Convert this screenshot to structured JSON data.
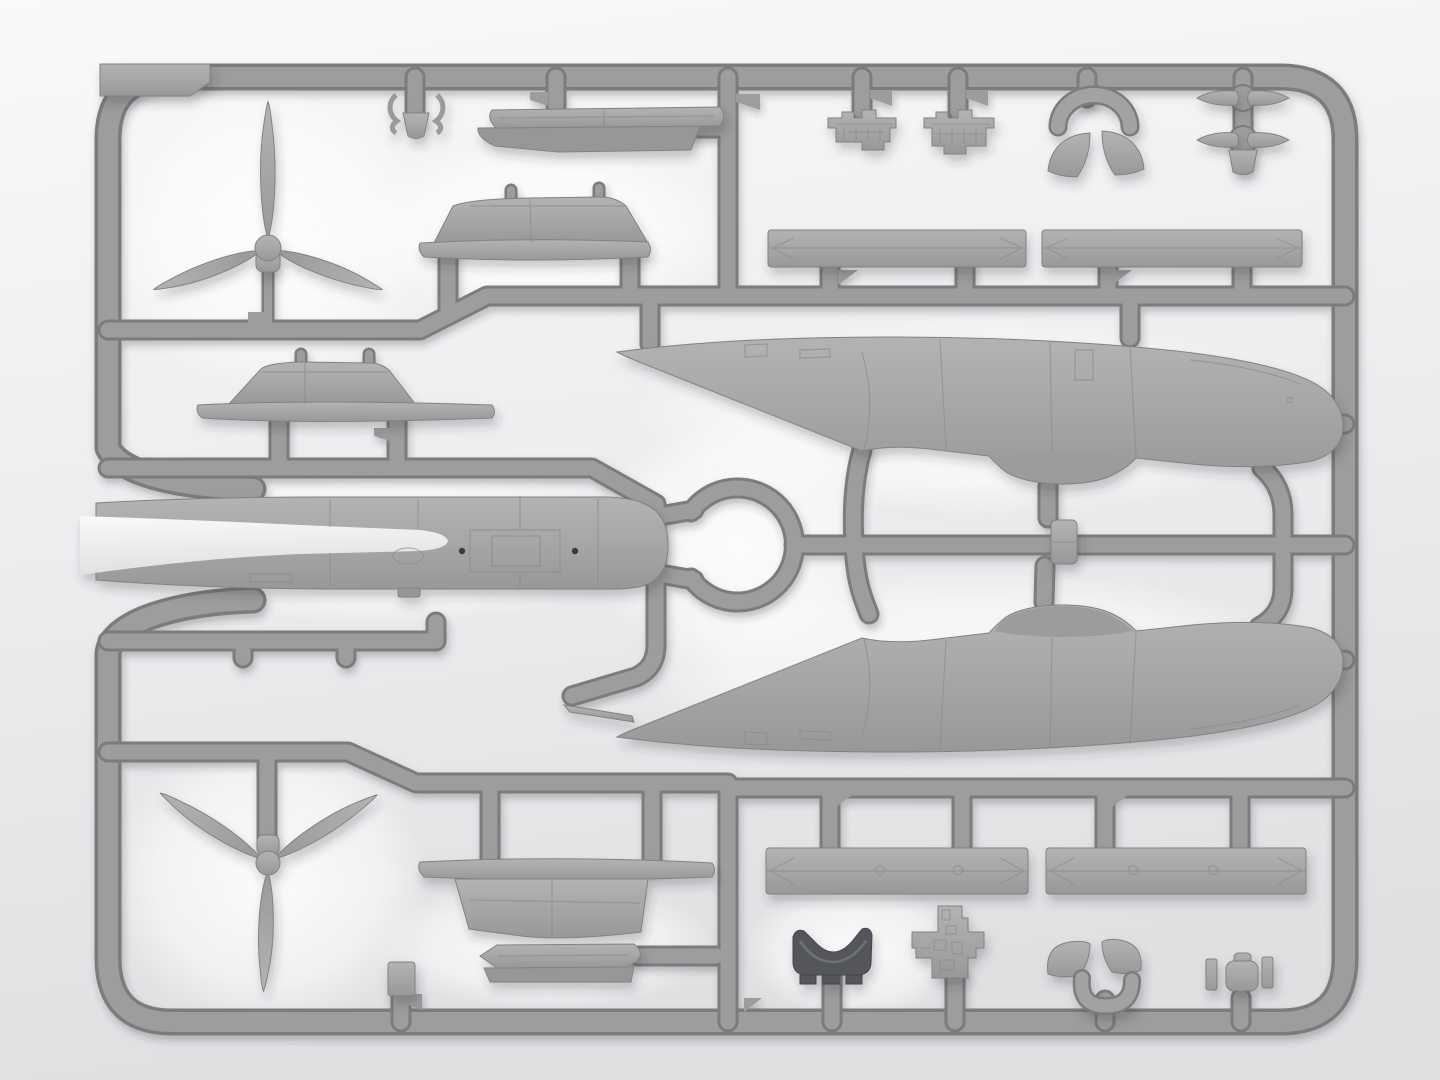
{
  "scene": {
    "description": "Product render of an injection-molded model aircraft kit sprue: light gray styrene parts attached to a rounded rectangular runner frame on a soft gradient studio background. No text is visible.",
    "subject": "model-kit-sprue",
    "orientation": "landscape"
  },
  "colors": {
    "background_top": "#f8f8f9",
    "background_bottom": "#e0e1e3",
    "runner_mid": "#9d9d9d",
    "runner_dark": "#7c7c7c",
    "part_light": "#b3b3b3",
    "part_mid": "#a5a5a5",
    "part_shadow": "#979797",
    "part_edge": "#828282",
    "detail_line": "#898989",
    "dark_part": "#54575b",
    "dark_part_edge": "#43464a",
    "dark_part_highlight": "#6e7276",
    "hole_dot": "#3a3a3a",
    "halo": "#ffffff"
  },
  "sprue": {
    "frame": "rounded-rectangle runner frame with blank label tab in top-left corner and an open left side where curved runner arms hug the twin-boom part",
    "sections": [
      "top-left: three-blade propeller, spring clip, flat stepped part, wing fairing section",
      "top-right: two engine blocks, cowl horseshoe with two quarter pieces, four exhaust bullets on a post, two long spar bars",
      "middle-left: wing fairing strip and large twin-boom center-section part",
      "center-right: two large nacelle/fuselage halves around a circular runner loop",
      "bottom-left: second three-blade propeller, wing fairing section, flat stepped part, small square block",
      "bottom-right: two long spar bars with rivet holes, dark intake saddle, stepped radio-rack part, cowl horseshoe with quarter pieces, T-fitting"
    ],
    "parts_inventory": [
      {
        "name": "three-blade-propeller",
        "qty": 2
      },
      {
        "name": "nacelle-fuselage-half",
        "qty": 2
      },
      {
        "name": "twin-boom-center-section",
        "qty": 1
      },
      {
        "name": "wing-fairing-section",
        "qty": 4
      },
      {
        "name": "flat-stepped-part",
        "qty": 2
      },
      {
        "name": "spar-bar",
        "qty": 4
      },
      {
        "name": "engine-block",
        "qty": 2
      },
      {
        "name": "cowl-horseshoe",
        "qty": 2
      },
      {
        "name": "cowl-quarter-piece",
        "qty": 4
      },
      {
        "name": "exhaust-bullet",
        "qty": 4
      },
      {
        "name": "dark-intake-saddle",
        "qty": 1
      },
      {
        "name": "stepped-rack-part",
        "qty": 1
      },
      {
        "name": "t-fitting",
        "qty": 1
      },
      {
        "name": "small-square-block",
        "qty": 1
      },
      {
        "name": "spring-clip-part",
        "qty": 1
      },
      {
        "name": "small-mount-block",
        "qty": 1
      },
      {
        "name": "pitot-needle",
        "qty": 1
      },
      {
        "name": "corner-label-tab",
        "qty": 1
      }
    ]
  }
}
